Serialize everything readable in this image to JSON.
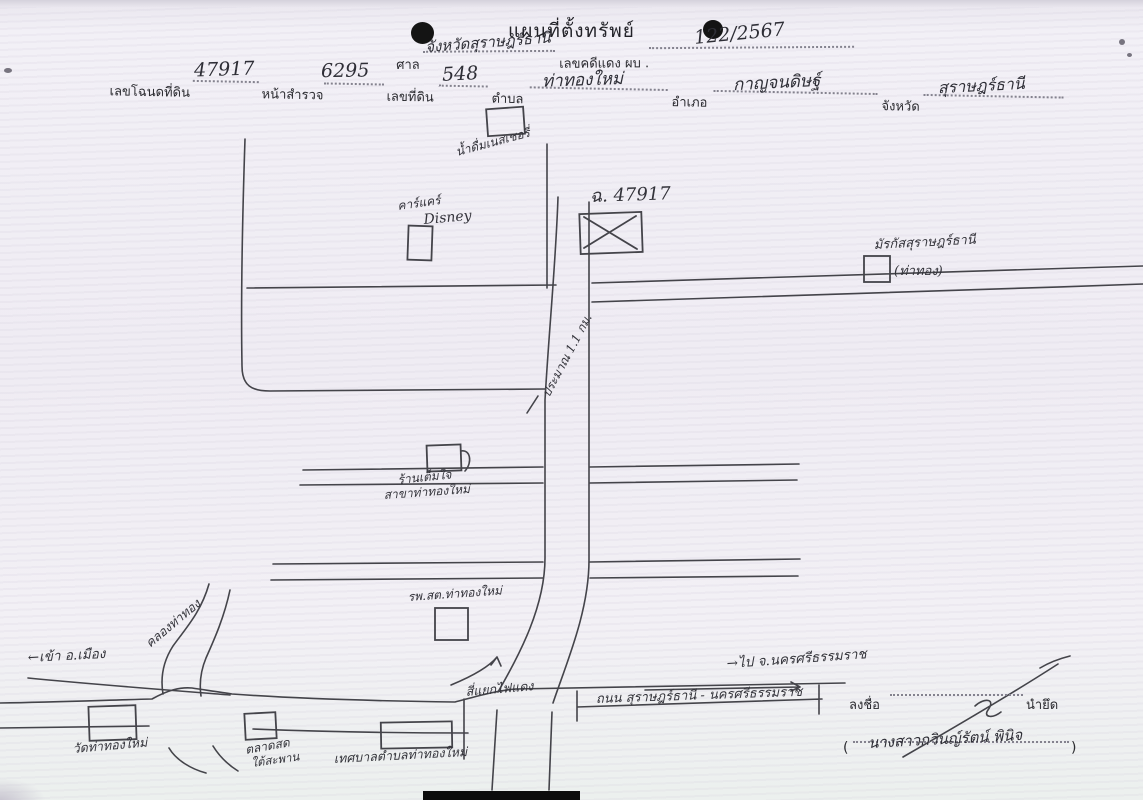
{
  "document": {
    "title": "แผนที่ตั้งทรัพย์",
    "court": {
      "label": "ศาล",
      "value": "จังหวัดสุราษฎร์ธานี"
    },
    "red_case": {
      "label": "เลขคดีแดง ผบ .",
      "value": "122/2567"
    },
    "deed": {
      "label": "เลขโฉนดที่ดิน",
      "value": "47917"
    },
    "survey": {
      "label": "หน้าสำรวจ",
      "value": "6295"
    },
    "parcel": {
      "label": "เลขที่ดิน",
      "value": "548"
    },
    "subdistrict": {
      "label": "ตำบล",
      "value": "ท่าทองใหม่"
    },
    "district": {
      "label": "อำเภอ",
      "value": "กาญจนดิษฐ์"
    },
    "province": {
      "label": "จังหวัด",
      "value": "สุราษฎร์ธานี"
    }
  },
  "map": {
    "labels": {
      "water_shop": "น้ำดื่มเนสเชอรี่",
      "car_care": "คาร์แคร์",
      "car_care_en": "Disney",
      "property_no": "ฉ. 47917",
      "markas_line1": "มัรกัสสุราษฎร์ธานี",
      "markas_line2": "(ท่าทอง)",
      "distance": "ประมาณ 1.1 กม.",
      "shop_line1": "ร้านเต็มใจ",
      "shop_line2": "สาขาท่าทองใหม่",
      "health_center": "รพ.สต.ท่าทองใหม่",
      "canal": "คลองท่าทอง",
      "to_city": "←เข้า อ.เมือง",
      "temple": "วัดท่าทองใหม่",
      "market_line1": "ตลาดสด",
      "market_line2": "ใต้สะพาน",
      "municipality": "เทศบาลตำบลท่าทองใหม่",
      "red_light": "สี่แยกไฟแดง",
      "main_road": "ถนน สุราษฎร์ธานี - นครศรีธรรมราช",
      "to_nakhon": "→ไป จ.นครศรีธรรมราช"
    }
  },
  "signature": {
    "sign_label": "ลงชื่อ",
    "role": "นำยึด",
    "paren_open": "(",
    "paren_close": ")",
    "name": "นางสาวกวินญ์รัตน์ พินิจ"
  },
  "colors": {
    "paper": "#f1eff5",
    "ink": "#3c3c42"
  }
}
